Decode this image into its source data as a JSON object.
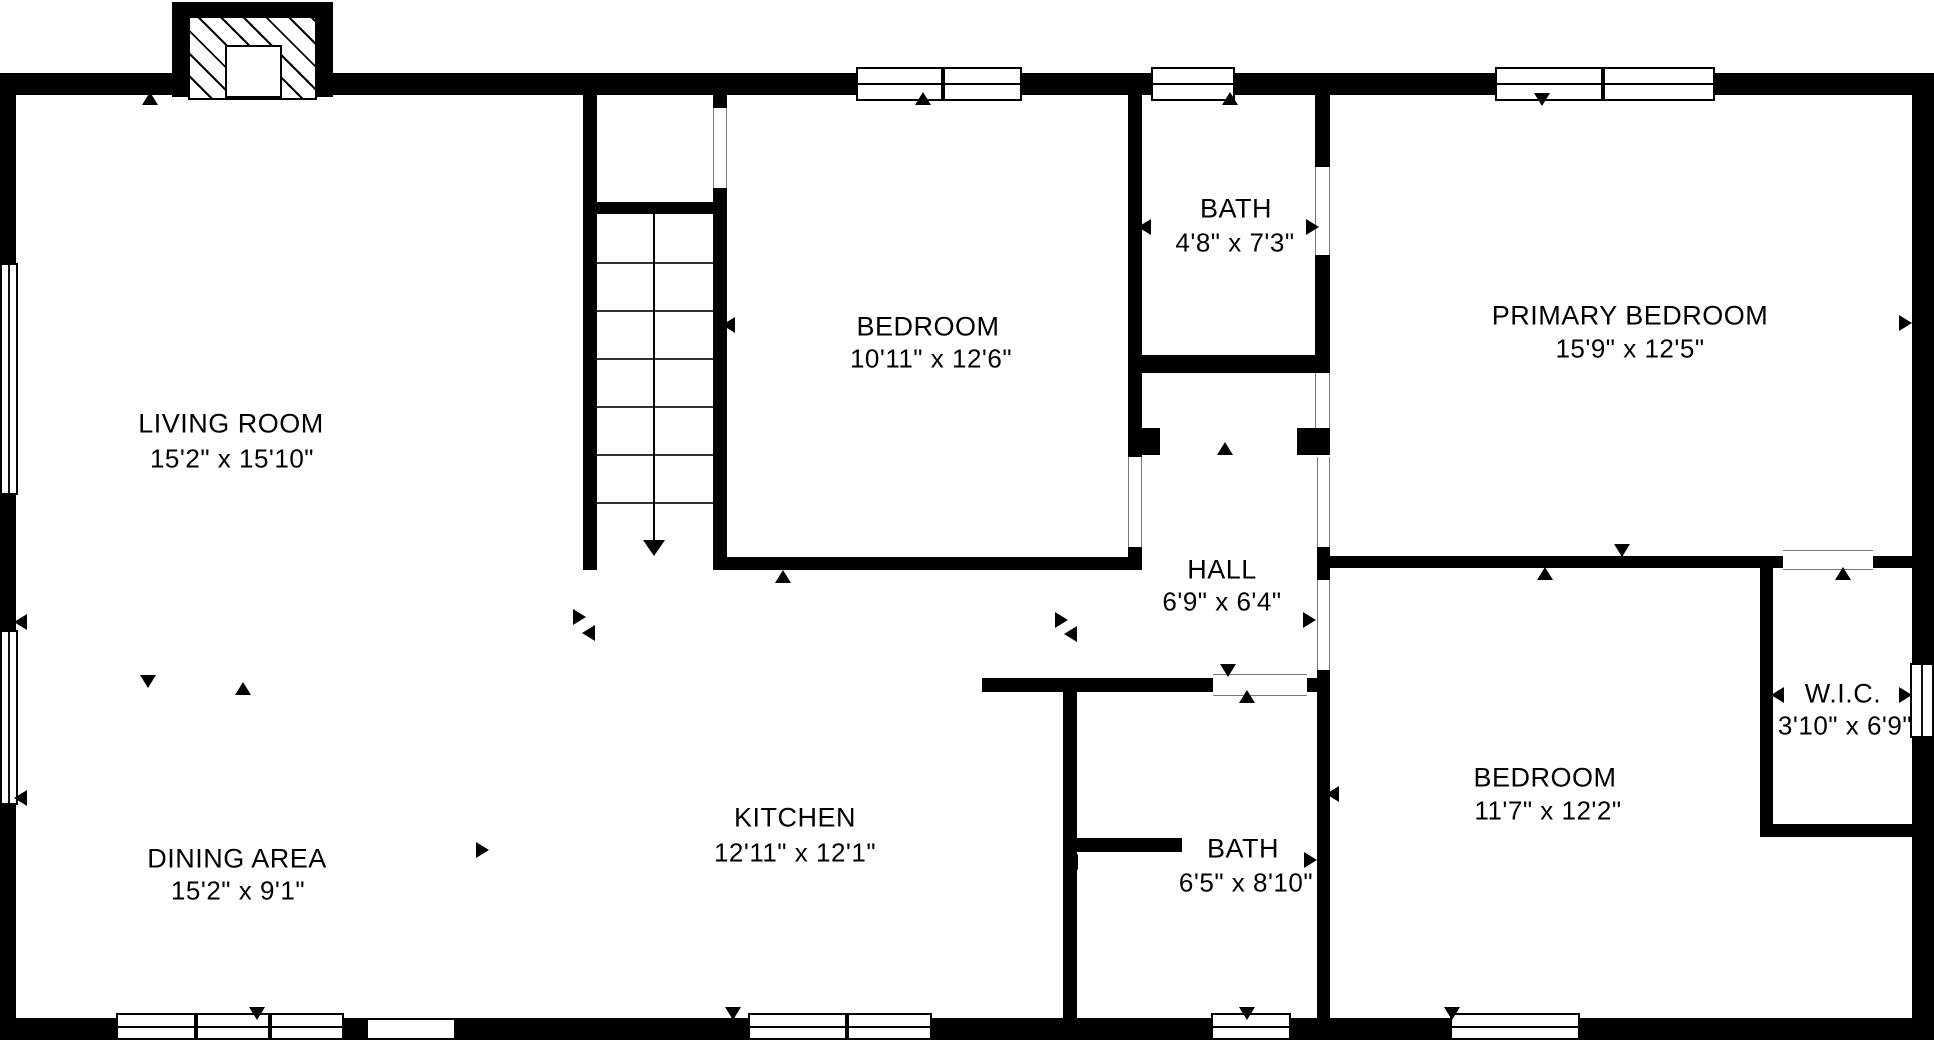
{
  "canvas": {
    "width": 1934,
    "height": 1040,
    "background": "#ffffff",
    "wall_color": "#000000",
    "text_color": "#000000"
  },
  "rooms": [
    {
      "id": "living-room",
      "name": "LIVING ROOM",
      "dims": "15'2\" x 15'10\"",
      "name_x": 231,
      "name_y": 424,
      "dims_x": 232,
      "dims_y": 459
    },
    {
      "id": "dining-area",
      "name": "DINING AREA",
      "dims": "15'2\" x 9'1\"",
      "name_x": 237,
      "name_y": 859,
      "dims_x": 238,
      "dims_y": 891
    },
    {
      "id": "kitchen",
      "name": "KITCHEN",
      "dims": "12'11\" x 12'1\"",
      "name_x": 795,
      "name_y": 818,
      "dims_x": 795,
      "dims_y": 853
    },
    {
      "id": "bedroom-top",
      "name": "BEDROOM",
      "dims": "10'11\" x 12'6\"",
      "name_x": 928,
      "name_y": 327,
      "dims_x": 931,
      "dims_y": 359
    },
    {
      "id": "bath-top",
      "name": "BATH",
      "dims": "4'8\" x 7'3\"",
      "name_x": 1236,
      "name_y": 209,
      "dims_x": 1235,
      "dims_y": 243
    },
    {
      "id": "primary-bedroom",
      "name": "PRIMARY BEDROOM",
      "dims": "15'9\" x 12'5\"",
      "name_x": 1630,
      "name_y": 316,
      "dims_x": 1630,
      "dims_y": 349
    },
    {
      "id": "hall",
      "name": "HALL",
      "dims": "6'9\" x 6'4\"",
      "name_x": 1222,
      "name_y": 570,
      "dims_x": 1222,
      "dims_y": 602
    },
    {
      "id": "bath-lower",
      "name": "BATH",
      "dims": "6'5\" x 8'10\"",
      "name_x": 1243,
      "name_y": 849,
      "dims_x": 1246,
      "dims_y": 883
    },
    {
      "id": "bedroom-lower",
      "name": "BEDROOM",
      "dims": "11'7\" x 12'2\"",
      "name_x": 1545,
      "name_y": 778,
      "dims_x": 1548,
      "dims_y": 811
    },
    {
      "id": "wic",
      "name": "W.I.C.",
      "dims": "3'10\" x 6'9\"",
      "name_x": 1843,
      "name_y": 694,
      "dims_x": 1845,
      "dims_y": 726
    }
  ],
  "walls": [
    [
      0,
      73,
      1934,
      22
    ],
    [
      0,
      1018,
      1934,
      22
    ],
    [
      0,
      73,
      16,
      967
    ],
    [
      1912,
      73,
      22,
      967
    ],
    [
      583,
      95,
      14,
      475
    ],
    [
      713,
      95,
      14,
      13
    ],
    [
      713,
      188,
      14,
      382
    ],
    [
      597,
      202,
      116,
      12
    ],
    [
      713,
      557,
      429,
      13
    ],
    [
      1128,
      95,
      14,
      362
    ],
    [
      1128,
      547,
      14,
      23
    ],
    [
      1128,
      355,
      202,
      18
    ],
    [
      1315,
      95,
      15,
      72
    ],
    [
      1315,
      255,
      15,
      100
    ],
    [
      1128,
      428,
      32,
      27
    ],
    [
      1297,
      428,
      33,
      27
    ],
    [
      1317,
      547,
      13,
      33
    ],
    [
      1317,
      670,
      13,
      348
    ],
    [
      1317,
      556,
      466,
      12
    ],
    [
      1873,
      556,
      39,
      12
    ],
    [
      1760,
      556,
      13,
      281
    ],
    [
      1760,
      824,
      152,
      13
    ],
    [
      982,
      678,
      231,
      14
    ],
    [
      1307,
      678,
      10,
      14
    ],
    [
      1063,
      692,
      14,
      326
    ],
    [
      1077,
      838,
      105,
      14
    ]
  ],
  "windows": [
    {
      "rect": [
        856,
        67,
        166,
        34
      ],
      "orient": "h",
      "mullions": [
        83
      ]
    },
    {
      "rect": [
        1151,
        67,
        84,
        34
      ],
      "orient": "h",
      "mullions": []
    },
    {
      "rect": [
        1495,
        67,
        220,
        34
      ],
      "orient": "h",
      "mullions": [
        104
      ]
    },
    {
      "rect": [
        116,
        1013,
        228,
        27
      ],
      "orient": "h",
      "mullions": [
        76,
        150
      ]
    },
    {
      "rect": [
        748,
        1013,
        184,
        27
      ],
      "orient": "h",
      "mullions": [
        95
      ]
    },
    {
      "rect": [
        1211,
        1013,
        80,
        27
      ],
      "orient": "h",
      "mullions": []
    },
    {
      "rect": [
        1450,
        1013,
        130,
        27
      ],
      "orient": "h",
      "mullions": []
    },
    {
      "rect": [
        0,
        263,
        18,
        232
      ],
      "orient": "v",
      "mullions": []
    },
    {
      "rect": [
        0,
        630,
        18,
        175
      ],
      "orient": "v",
      "mullions": []
    },
    {
      "rect": [
        1910,
        663,
        24,
        75
      ],
      "orient": "v",
      "mullions": []
    }
  ],
  "door_openings": [
    {
      "rect": [
        713,
        108,
        14,
        80
      ],
      "orient": "v",
      "style": "frame"
    },
    {
      "rect": [
        1128,
        457,
        14,
        90
      ],
      "orient": "v",
      "style": "frame"
    },
    {
      "rect": [
        1317,
        457,
        13,
        90
      ],
      "orient": "v",
      "style": "frame"
    },
    {
      "rect": [
        1315,
        167,
        15,
        88
      ],
      "orient": "v",
      "style": "frame"
    },
    {
      "rect": [
        1315,
        373,
        15,
        55
      ],
      "orient": "v",
      "style": "frame"
    },
    {
      "rect": [
        1317,
        580,
        13,
        90
      ],
      "orient": "v",
      "style": "frame"
    },
    {
      "rect": [
        1213,
        674,
        94,
        22
      ],
      "orient": "h",
      "style": "frame"
    },
    {
      "rect": [
        1783,
        550,
        90,
        20
      ],
      "orient": "h",
      "style": "frame"
    },
    {
      "rect": [
        365,
        1020,
        92,
        18
      ],
      "orient": "h",
      "style": "cap"
    }
  ],
  "arrows": [
    [
      150,
      99,
      "up"
    ],
    [
      923,
      99,
      "up"
    ],
    [
      1230,
      99,
      "up"
    ],
    [
      1542,
      100,
      "down"
    ],
    [
      729,
      325,
      "left"
    ],
    [
      1145,
      227,
      "left"
    ],
    [
      1313,
      227,
      "right"
    ],
    [
      783,
      577,
      "up"
    ],
    [
      580,
      617,
      "right"
    ],
    [
      589,
      633,
      "left"
    ],
    [
      148,
      682,
      "down"
    ],
    [
      243,
      689,
      "up"
    ],
    [
      1062,
      620,
      "right"
    ],
    [
      1071,
      634,
      "left"
    ],
    [
      1310,
      620,
      "right"
    ],
    [
      1225,
      449,
      "up"
    ],
    [
      1622,
      551,
      "down"
    ],
    [
      1545,
      574,
      "up"
    ],
    [
      1843,
      574,
      "up"
    ],
    [
      1228,
      671,
      "down"
    ],
    [
      1247,
      697,
      "up"
    ],
    [
      1072,
      862,
      "left"
    ],
    [
      1311,
      860,
      "right"
    ],
    [
      1333,
      794,
      "left"
    ],
    [
      257,
      1014,
      "down"
    ],
    [
      483,
      850,
      "right"
    ],
    [
      733,
      1014,
      "down"
    ],
    [
      1247,
      1014,
      "down"
    ],
    [
      1452,
      1014,
      "down"
    ],
    [
      21,
      622,
      "left"
    ],
    [
      21,
      798,
      "left"
    ],
    [
      1906,
      323,
      "right"
    ],
    [
      1906,
      695,
      "right"
    ],
    [
      1778,
      695,
      "left"
    ]
  ],
  "stairs": {
    "x": 597,
    "y": 214,
    "w": 116,
    "h": 343,
    "treads_y": [
      262,
      310,
      358,
      406,
      454,
      502
    ],
    "direction_line": {
      "x": 653,
      "y1": 214,
      "y2": 540
    },
    "arrow_tip": {
      "x": 654,
      "y": 556
    }
  },
  "fireplace": {
    "frame": [
      172,
      2,
      161,
      95
    ],
    "hatch": [
      188,
      16,
      129,
      84
    ],
    "insert": [
      225,
      45,
      57,
      53
    ]
  }
}
